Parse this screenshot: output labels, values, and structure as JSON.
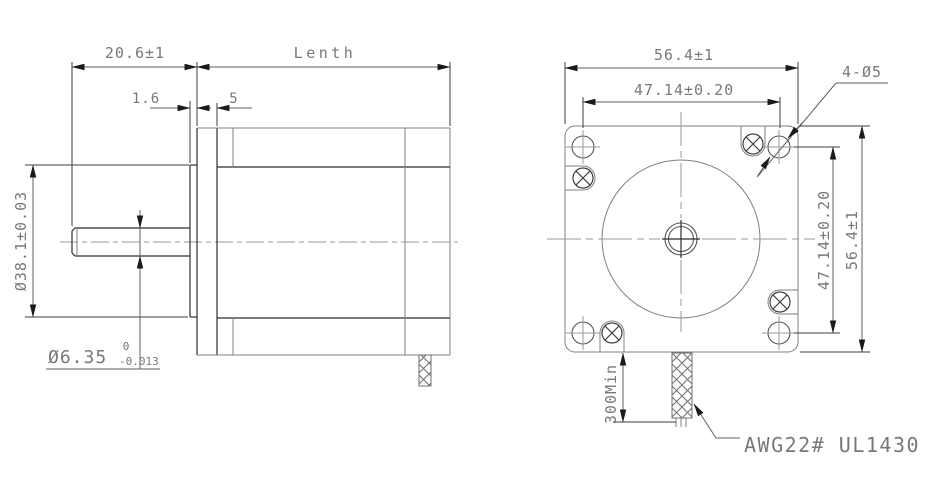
{
  "side_view": {
    "shaft_length": "20.6±1",
    "body_length_label": "Lenth",
    "pilot_depth": "1.6",
    "flange_thickness": "5",
    "pilot_diameter": "Ø38.1±0.03",
    "shaft_diameter": "Ø6.35",
    "shaft_tol_upper": "0",
    "shaft_tol_lower": "-0.013"
  },
  "front_view": {
    "flange_width": "56.4±1",
    "hole_spacing_h": "47.14±0.20",
    "holes_callout": "4-Ø5",
    "hole_spacing_v": "47.14±0.20",
    "flange_height": "56.4±1",
    "lead_length": "300Min",
    "lead_spec": "AWG22# UL1430"
  },
  "colors": {
    "background": "#ffffff",
    "outline_gray": "#808080",
    "outline_dark": "#2f2f2f",
    "dimension_line": "#5f5f5f",
    "text": "#787878"
  }
}
